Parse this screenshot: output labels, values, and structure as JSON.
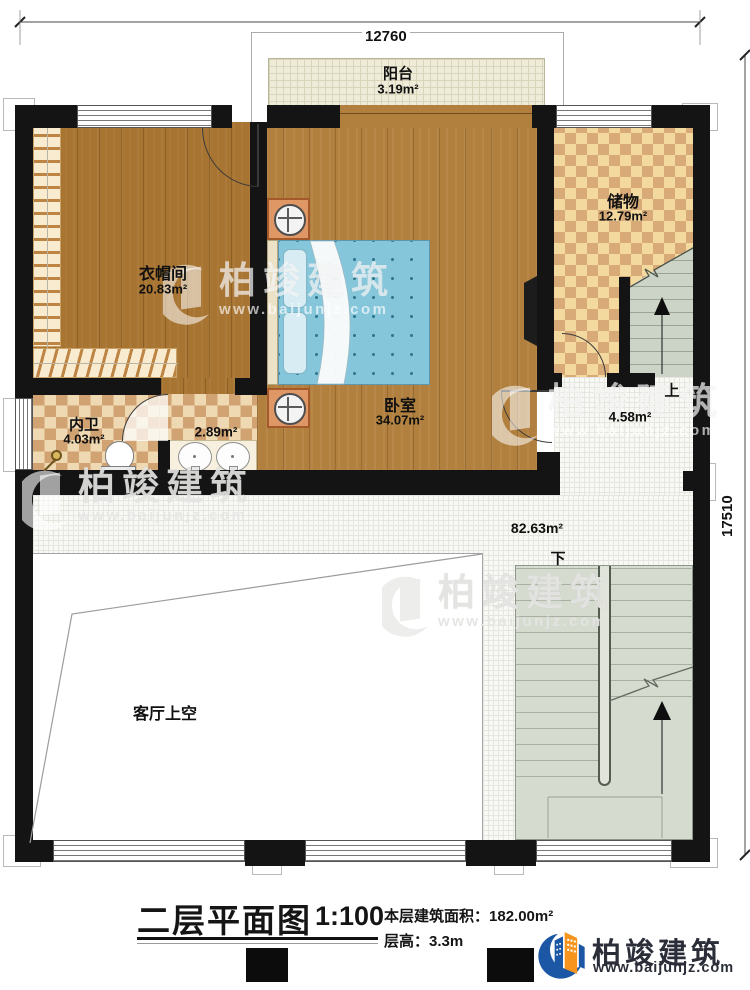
{
  "dimensions": {
    "width": "12760",
    "height": "17510"
  },
  "rooms": {
    "balcony": {
      "name": "阳台",
      "area": "3.19m²"
    },
    "cloakroom": {
      "name": "衣帽间",
      "area": "20.83m²"
    },
    "bedroom": {
      "name": "卧室",
      "area": "34.07m²"
    },
    "storage": {
      "name": "储物",
      "area": "12.79m²"
    },
    "bathroom": {
      "name": "内卫",
      "area": "4.03m²"
    },
    "vanity": {
      "area": "2.89m²"
    },
    "stair_landing": {
      "area": "4.58m²"
    },
    "hall": {
      "area": "82.63m²"
    },
    "living_void": {
      "name": "客厅上空"
    }
  },
  "stairs": {
    "up_label": "上",
    "down_label": "下"
  },
  "title_block": {
    "title": "二层平面图",
    "scale": "1:100",
    "area_label": "本层建筑面积：",
    "area_value": "182.00m²",
    "height_label": "层高：",
    "height_value": "3.3m"
  },
  "brand": {
    "name": "柏竣建筑",
    "site": "www.baijunjz.com"
  }
}
